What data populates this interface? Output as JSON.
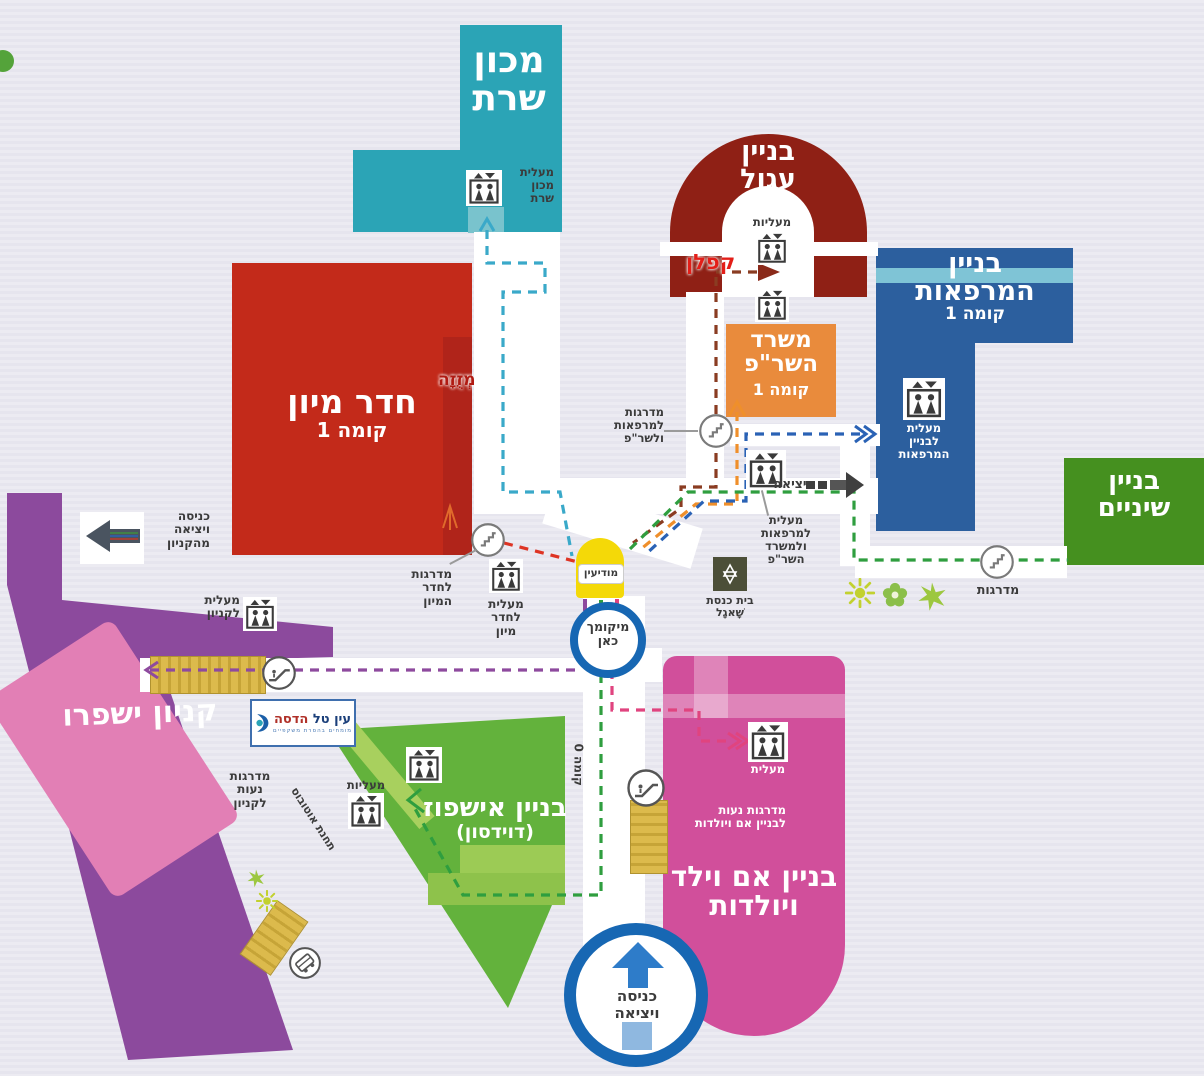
{
  "background": "#e8e7ef",
  "buildings": {
    "sharett": {
      "label": "מכון\nשרת",
      "color": "#2ba4b6"
    },
    "round": {
      "label": "בניין\nעגול",
      "color": "#8f2015"
    },
    "clinics": {
      "label": "בניין\nהמרפאות",
      "floor": "קומה 1",
      "color": "#2c5f9e"
    },
    "dental": {
      "label": "בניין\nשיניים",
      "color": "#45901f"
    },
    "er": {
      "label": "חדר מיון",
      "floor": "קומה 1",
      "color": "#c32a1a"
    },
    "sharap": {
      "label": "משרד\nהשר\"פ",
      "floor": "קומה 1",
      "color": "#e98b3c"
    },
    "mall": {
      "label": "קניון ישפרו",
      "color": "#8c4a9d"
    },
    "davidson": {
      "label": "בניין אישפוז",
      "sublabel": "(דוידסון)",
      "color": "#63b23c"
    },
    "mother_child": {
      "label": "בניין אם וילד\nויולדות",
      "color": "#d14f9b"
    }
  },
  "annotations": {
    "kaplan": "קפלן",
    "mezuzah": "מְזֻזָה"
  },
  "labels": {
    "elevator_sharett": "מעלית\nמכון\nשרת",
    "elevators": "מעליות",
    "elevator_clinics": "מעלית\nלבניין\nהמרפאות",
    "stairs_clinics_sharap": "מדרגות\nלמרפאות\nולשר\"פ",
    "elevator_clinics_sharap": "מעלית\nלמרפאות\nולמשרד\nהשר\"פ",
    "exit": "יציאה",
    "stairs": "מדרגות",
    "stairs_er": "מדרגות\nלחדר\nהמיון",
    "elevator_er": "מעלית\nלחדר\nמיון",
    "synagogue": "בית כנסת\nשָׁאגָל",
    "mall_exit": "כניסה\nויציאה\nמהקניון",
    "elevator_mall": "מעלית\nלקניון",
    "escalator_mall": "מדרגות\nנעות\nלקניון",
    "bus_station": "תחנת אוטובוס",
    "elevators_davidson": "מעליות",
    "floor0": "קומה 0",
    "elevator_mc": "מעלית",
    "escalator_mc": "מדרגות נעות\nלבניין אם ויולדות"
  },
  "markers": {
    "entrance": "כניסה\nויציאה",
    "you_are_here": "מיקומך\nכאן",
    "info": "מודיעין"
  },
  "logo": {
    "name1": "עין טל",
    "name2": "הדסה",
    "tagline": "מומחים בהסרת משקפיים"
  },
  "routes": {
    "teal": "#3aa9c9",
    "brown": "#8a3c22",
    "orange": "#ef8f2b",
    "blue": "#2a62b5",
    "green": "#2f9e3f",
    "red": "#de3424",
    "purple": "#8e4a9e",
    "pink": "#e0447f"
  }
}
